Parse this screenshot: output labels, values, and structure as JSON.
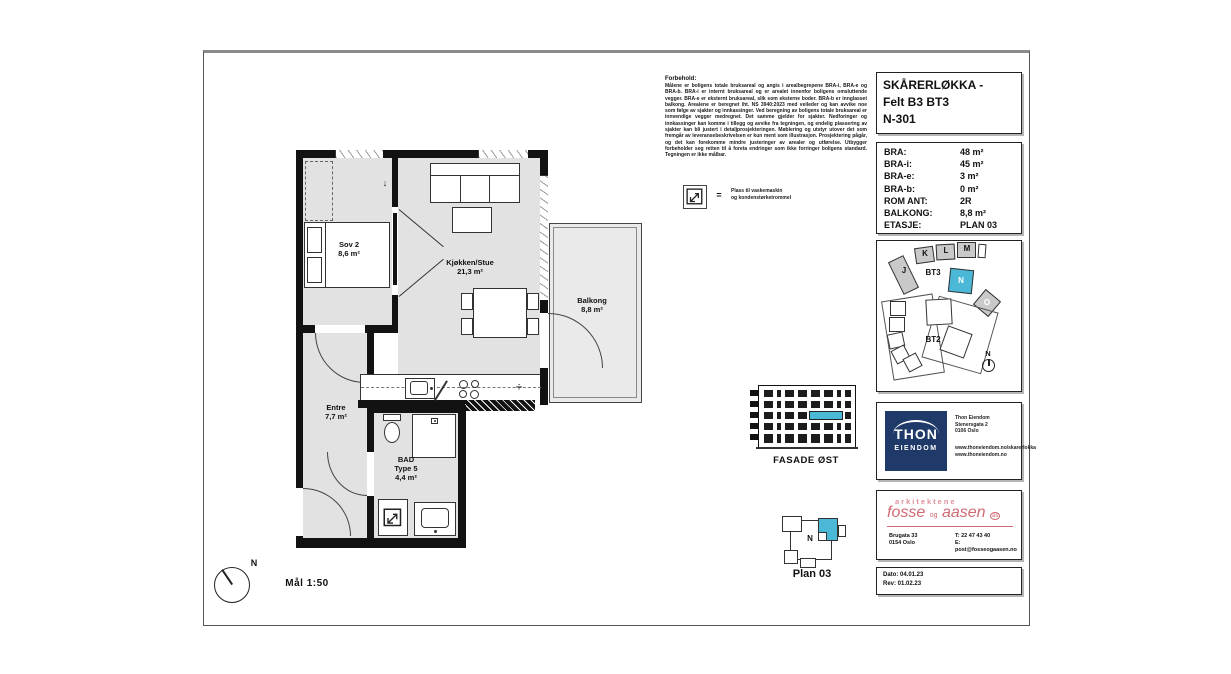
{
  "title_block": {
    "line1": "SKÅRERLØKKA -",
    "line2": "Felt B3 BT3",
    "line3": "N-301"
  },
  "area_table": {
    "rows": [
      {
        "label": "BRA:",
        "value": "48 m²"
      },
      {
        "label": "BRA-i:",
        "value": "45 m²"
      },
      {
        "label": "BRA-e:",
        "value": "3 m²"
      },
      {
        "label": "BRA-b:",
        "value": "0 m²"
      },
      {
        "label": "ROM ANT:",
        "value": "2R"
      },
      {
        "label": "BALKONG:",
        "value": "8,8 m²"
      },
      {
        "label": "ETASJE:",
        "value": "PLAN 03"
      }
    ]
  },
  "rooms": {
    "sov2": {
      "name": "Sov 2",
      "area": "8,6 m²"
    },
    "stue": {
      "name": "Kjøkken/Stue",
      "area": "21,3 m²"
    },
    "balkong": {
      "name": "Balkong",
      "area": "8,8 m²"
    },
    "entre": {
      "name": "Entre",
      "area": "7,7 m²"
    },
    "bad": {
      "name": "BAD",
      "type": "Type 5",
      "area": "4,4 m²"
    }
  },
  "plan": {
    "scale_label": "Mål 1:50",
    "north_label": "N",
    "entry_arrow": "↓",
    "dishwasher_symbol": "÷"
  },
  "disclaimer": {
    "title": "Forbehold:",
    "body": "Målene er boligens totale bruksareal og angis i arealbegrepene BRA-i, BRA-e og BRA-b. BRA-i er internt bruksareal og er arealet innenfor boligens omsluttende vegger. BRA-e er eksternt bruksareal, slik som eksterne boder. BRA-b er innglasset balkong. Arealene er beregnet iht. NS 3940:2023 med veileder og kan avvike noe som følge av sjakter og innkassinger. Ved beregning av boligens totale bruksareal er innvendige vegger medregnet. Det samme gjelder for sjakter. Nedforinger og innkassinger kan komme i tillegg og avvike fra tegningen, og endelig plassering av sjakter kan bli justert i detaljprosjekteringen. Møblering og utstyr utover det som fremgår av leveransebeskrivelsen er kun ment som illustrasjon. Prosjektering pågår, og det kan forekomme mindre justeringer av arealer og utførelse. Utbygger forbeholder seg retten til å foreta endringer som ikke forringer boligens standard. Tegningen er ikke målbar."
  },
  "legend": {
    "equals": "=",
    "line1": "Plass til vaskemaskin",
    "line2": "og kondenstørketrommel"
  },
  "site_map": {
    "building_j": "J",
    "building_k": "K",
    "building_l": "L",
    "building_m": "M",
    "label_bt3": "BT3",
    "label_unit": "N",
    "label_o": "O",
    "label_bt2": "BT2",
    "north_label": "N",
    "highlight_color": "#4cb8d8"
  },
  "facade": {
    "label": "FASADE ØST",
    "floors": 5,
    "highlight_floor": 3,
    "highlight_color": "#4cb8d8"
  },
  "plan_key": {
    "unit_label": "N",
    "caption": "Plan 03"
  },
  "developer": {
    "name_top": "THON",
    "name_bottom": "EIENDOM",
    "address": "Thon Eiendom\nStenersgata 2\n0106 Oslo",
    "web": "www.thoneiendom.no/skarerlokka\nwww.thoneiendom.no",
    "brand_color": "#1f3a68"
  },
  "architect": {
    "tagline": "arkitektene",
    "name_a": "fosse",
    "name_og": "og",
    "name_b": "aasen",
    "suffix": "as",
    "address": "Brugata 33\n0154 Oslo",
    "contact": "T: 22 47 43 40\nE: post@fosseogaasen.no",
    "brand_color": "#d26a74"
  },
  "revision": {
    "date": "Dato: 04.01.23",
    "rev": "Rev:   01.02.23"
  }
}
